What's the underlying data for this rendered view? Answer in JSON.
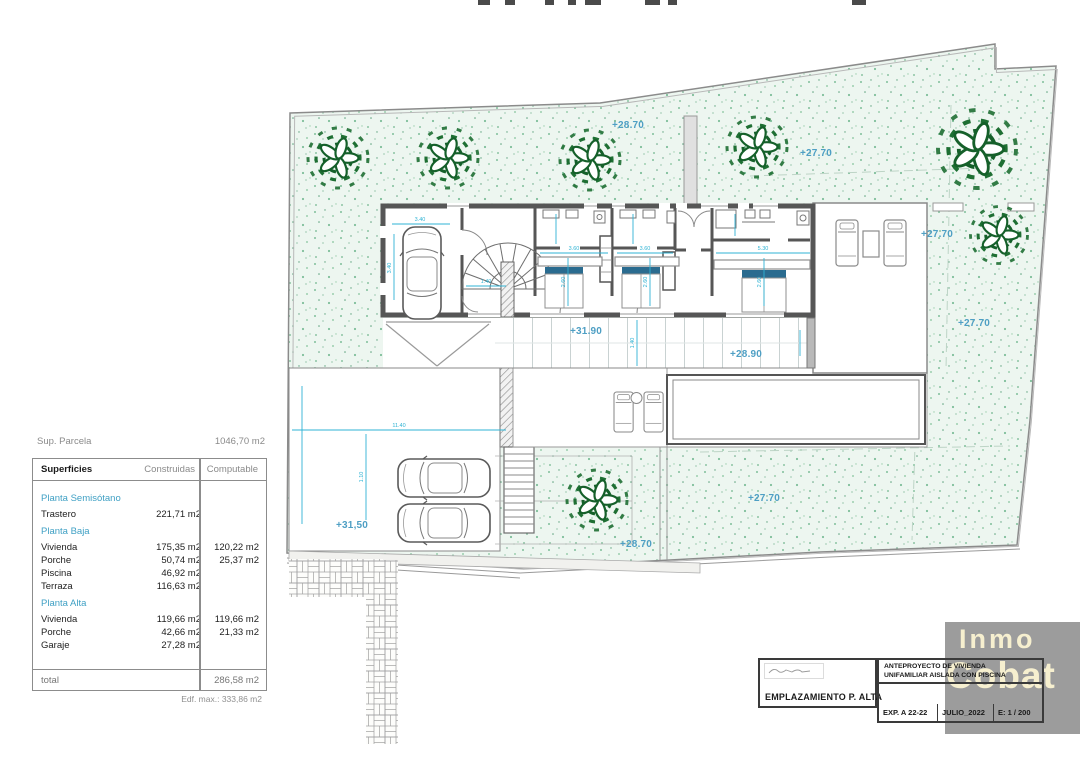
{
  "annotations": {
    "garden_top": "+28.70",
    "garden_upper_right": "+27.70",
    "garden_right_mid": "+27.70",
    "garden_right_low": "+27.70",
    "terrace_main": "+31.90",
    "terrace_right": "+28.90",
    "garden_low_right": "+27.70",
    "garden_low_left": "+28.70",
    "parking": "+31,50"
  },
  "dimensions": {
    "garage_width": "3.40",
    "garage_depth": "3.40",
    "hall": "1.40",
    "bed1_width": "3.60",
    "bed1_depth": "2.60",
    "bed2_width": "3.60",
    "bed2_depth": "2.60",
    "master_width": "5.30",
    "master_depth": "2.60",
    "terrace_depth": "1.40",
    "parking_width": "11.40",
    "parking_depth": "1.10"
  },
  "summary": {
    "label": "Sup. Parcela",
    "value": "1046,70 m2"
  },
  "table": {
    "headers": {
      "name": "Superficies",
      "built": "Construidas",
      "computable": "Computable"
    },
    "rows": [
      {
        "label": "Planta Semisótano",
        "built": "",
        "computable": ""
      },
      {
        "label": "Trastero",
        "built": "221,71 m2",
        "computable": ""
      },
      {
        "label": "Planta Baja",
        "built": "",
        "computable": ""
      },
      {
        "label": "Vivienda",
        "built": "175,35 m2",
        "computable": "120,22 m2"
      },
      {
        "label": "Porche",
        "built": "50,74 m2",
        "computable": "25,37 m2"
      },
      {
        "label": "Piscina",
        "built": "46,92 m2",
        "computable": ""
      },
      {
        "label": "Terraza",
        "built": "116,63 m2",
        "computable": ""
      },
      {
        "label": "Planta Alta",
        "built": "",
        "computable": ""
      },
      {
        "label": "Vivienda",
        "built": "119,66 m2",
        "computable": "119,66 m2"
      },
      {
        "label": "Porche",
        "built": "42,66 m2",
        "computable": "21,33 m2"
      },
      {
        "label": "Garaje",
        "built": "27,28 m2",
        "computable": ""
      }
    ],
    "total": {
      "label": "total",
      "computable": "286,58 m2"
    },
    "footnote": "Edf. max.: 333,86 m2"
  },
  "titleblock": {
    "drawing_title": "EMPLAZAMIENTO P. ALTA",
    "project_line1": "ANTEPROYECTO  DE VIVIENDA",
    "project_line2": "UNIFAMILIAR AISLADA CON PISCINA",
    "exp": "EXP. A 22-22",
    "date": "JULIO_2022",
    "scale": "E: 1 / 200"
  },
  "logo": {
    "line1": "Inmo",
    "line2": "Cobat"
  },
  "colors": {
    "accent_cyan": "#2fb3d4",
    "elevation_blue": "#4e9fc4",
    "wall_gray": "#565656",
    "tree_green": "#1e6f33",
    "bed_headboard": "#2a6b8f",
    "logo_bg": "#9c9c9c",
    "logo_text": "#f6efcf"
  }
}
